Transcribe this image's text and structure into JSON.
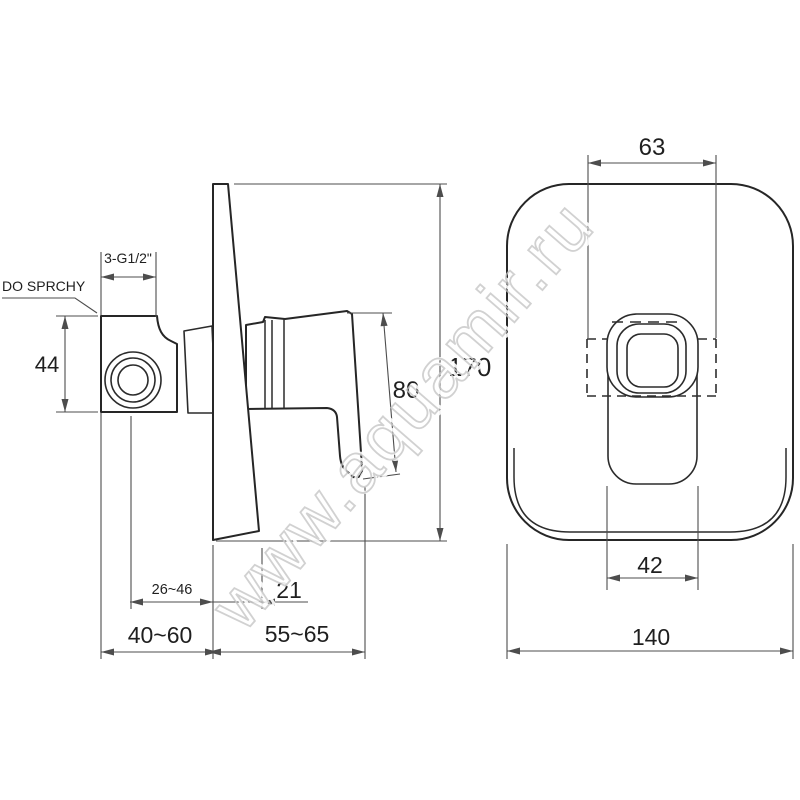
{
  "canvas": {
    "width": 800,
    "height": 800,
    "background": "#ffffff"
  },
  "style": {
    "outline_color": "#262626",
    "dimension_color": "#4d4d4d",
    "watermark_color": "#c6c6c6"
  },
  "watermark": {
    "text": "www.aquamir.ru"
  },
  "side_view": {
    "labels": {
      "outlet_label": "DO SPRCHY",
      "thread_size": "3-G1/2\"",
      "outlet_height": "44",
      "lever_length": "170",
      "handle_length": "80",
      "depth_adjust_inner": "26~46",
      "lever_tip_width": "21",
      "depth_range_outlet": "40~60",
      "depth_range_handle": "55~65"
    }
  },
  "front_view": {
    "labels": {
      "box_cutout_width": "63",
      "handle_width": "42",
      "plate_width": "140"
    }
  }
}
